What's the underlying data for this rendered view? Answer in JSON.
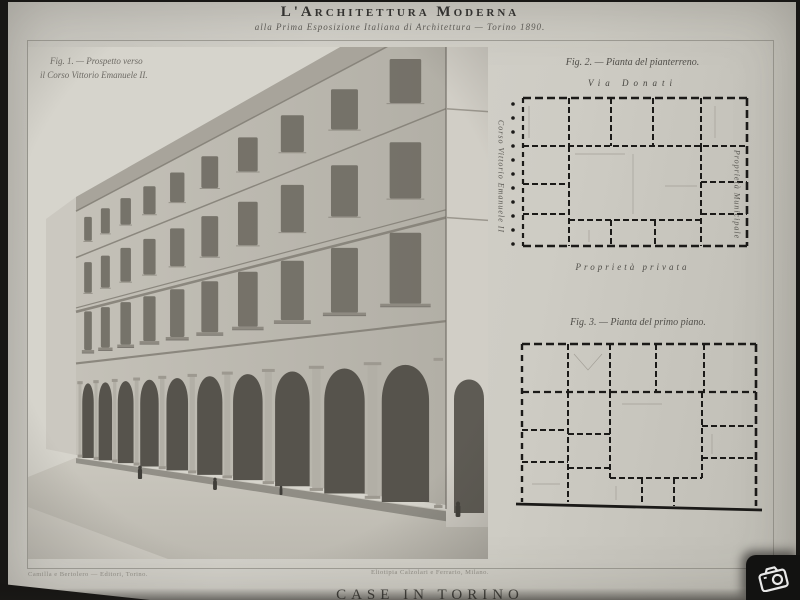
{
  "masthead": {
    "title": "L'Architettura Moderna",
    "subtitle": "alla Prima Esposizione Italiana di Architettura — Torino 1890."
  },
  "figure1": {
    "caption_line1": "Fig. 1. — Prospetto verso",
    "caption_line2": "il Corso Vittorio Emanuele II."
  },
  "ground_plan": {
    "caption": "Fig. 2. — Pianta del pianterreno.",
    "street_top": "Via Donati",
    "street_left": "Corso Vittorio Emanuele II",
    "label_right": "Proprietà Municipale",
    "label_bottom": "Proprietà privata"
  },
  "first_plan": {
    "caption": "Fig. 3. — Pianta del primo piano."
  },
  "footer": {
    "imprint_left": "Camilla e Bertolero — Editori, Torino.",
    "imprint_center": "Eliotipia Calzolari e Ferrario, Milano.",
    "plate_title_clipped": "CASE IN TORINO"
  },
  "watermark": {
    "icon": "camera-icon"
  },
  "colors": {
    "paper": "#ceccc4",
    "ink": "#1b1a18",
    "caption_ink": "#504e49",
    "scan_edge": "#181715",
    "photo_shadow": "#56534c",
    "photo_light": "#d6d4cc"
  }
}
